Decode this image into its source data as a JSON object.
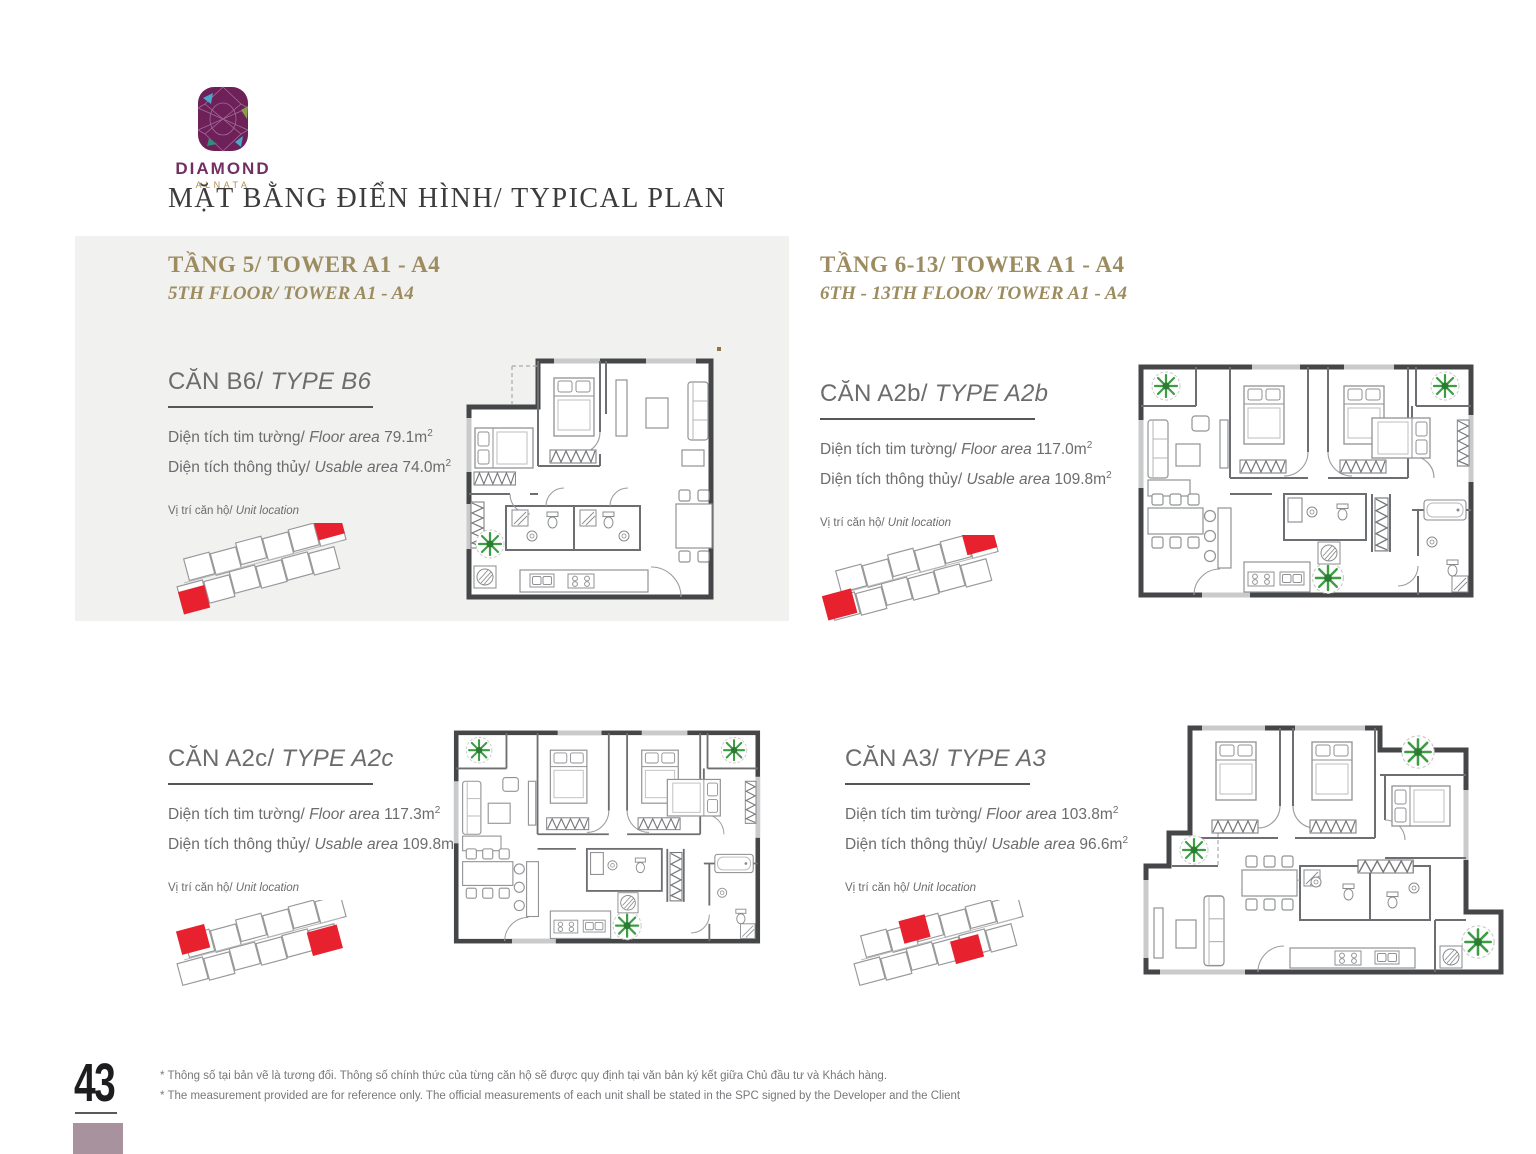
{
  "brand": {
    "name": "DIAMOND",
    "sub": "ALNATA"
  },
  "page_title": "MẶT BẰNG ĐIỂN HÌNH/ TYPICAL PLAN",
  "sections": {
    "tang5": {
      "title": "TẦNG 5/ TOWER A1 - A4",
      "subtitle": "5TH FLOOR/ TOWER A1 - A4"
    },
    "tang613": {
      "title": "TẦNG 6-13/ TOWER A1 - A4",
      "subtitle": "6TH - 13TH FLOOR/ TOWER A1 - A4"
    }
  },
  "labels": {
    "floor_area_vi": "Diện tích tim tường/",
    "floor_area_en": "Floor area",
    "usable_area_vi": "Diện tích thông thủy/",
    "usable_area_en": "Usable area",
    "unit_location_vi": "Vị trí căn hộ/",
    "unit_location_en": "Unit location",
    "sup": "2"
  },
  "units": [
    {
      "name_vi": "CĂN B6/",
      "name_en": "TYPE B6",
      "floor_area": "79.1m",
      "usable_area": "74.0m"
    },
    {
      "name_vi": "CĂN A2b/",
      "name_en": "TYPE A2b",
      "floor_area": "117.0m",
      "usable_area": "109.8m"
    },
    {
      "name_vi": "CĂN A2c/",
      "name_en": "TYPE A2c",
      "floor_area": "117.3m",
      "usable_area": "109.8m"
    },
    {
      "name_vi": "CĂN A3/",
      "name_en": "TYPE A3",
      "floor_area": "103.8m",
      "usable_area": "96.6m"
    }
  ],
  "footer": {
    "page_number": "43",
    "note_vi": "* Thông số tại bản vẽ là tương đối. Thông số chính thức của từng căn hộ sẽ được quy định tại văn bản ký kết giữa Chủ đầu tư và Khách hàng.",
    "note_en": "* The measurement provided are for reference only. The official measurements of each unit shall be stated in the SPC signed by the Developer and the Client"
  },
  "colors": {
    "accent_gold": "#9c8c60",
    "text_gray": "#6b6c6e",
    "highlight_red": "#e8212f",
    "brand_purple": "#6d2158",
    "panel_gray": "#f1f1ef",
    "footer_mauve": "#a7929d"
  }
}
